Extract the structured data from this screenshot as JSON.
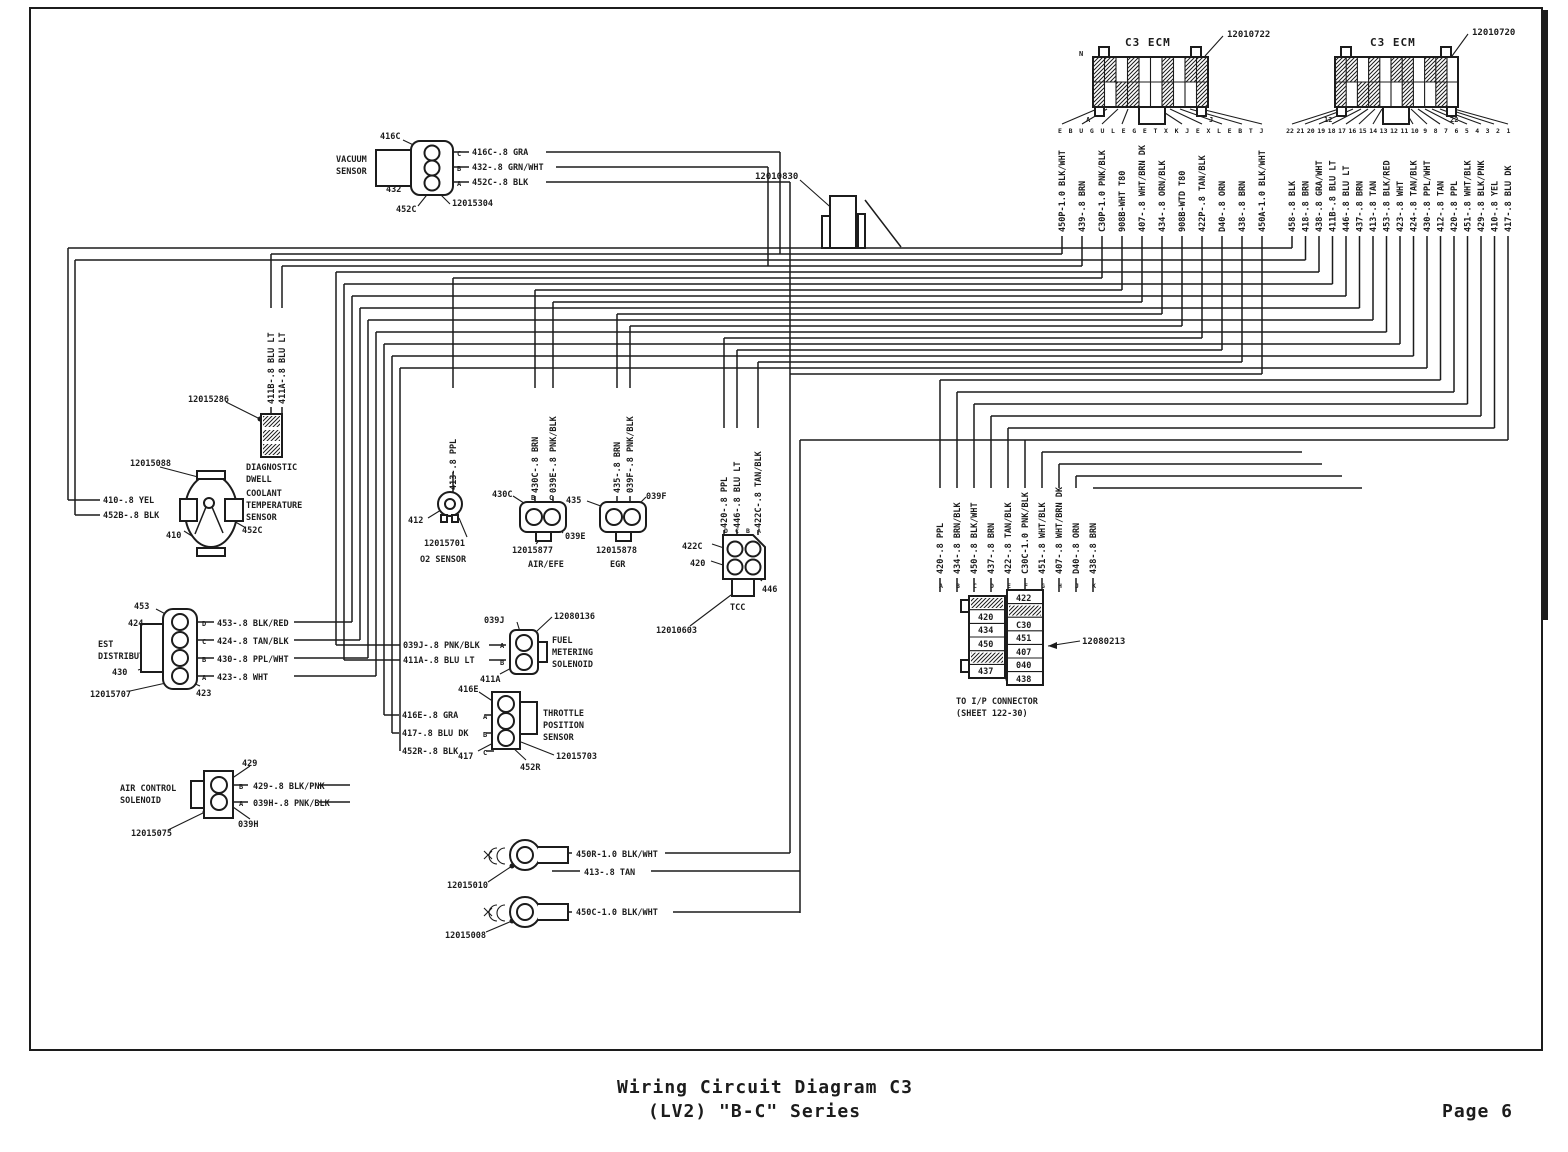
{
  "page": {
    "title_line1": "Wiring Circuit Diagram C3",
    "title_line2": "(LV2) \"B-C\" Series",
    "page_number": "Page 6"
  },
  "colors": {
    "ink": "#1c1c1c",
    "paper": "#ffffff"
  },
  "ecm_left": {
    "title": "C3 ECM",
    "part": "12010722",
    "corner_top": "N",
    "corner_bottom_left": "A",
    "corner_bottom_right": "J",
    "pins": [
      "E",
      "B",
      "U",
      "G",
      "U",
      "L",
      "E",
      "G",
      "E",
      "T",
      "X",
      "K",
      "J",
      "E",
      "X",
      "L",
      "E",
      "B",
      "T",
      "J"
    ],
    "wires": [
      "450P-1.0 BLK/WHT",
      "439-.8 BRN",
      "C30P-1.0 PNK/BLK",
      "908B-WHT T80",
      "407-.8 WHT/BRN DK",
      "434-.8 ORN/BLK",
      "908B-WTD T80",
      "422P-.8 TAN/BLK",
      "D40-.8 ORN",
      "438-.8 BRN",
      "450A-1.0 BLK/WHT"
    ]
  },
  "ecm_right": {
    "title": "C3 ECM",
    "part": "12010720",
    "corner_bottom_left": "12",
    "corner_bottom_right": "22",
    "pins": [
      "22",
      "21",
      "20",
      "19",
      "18",
      "17",
      "16",
      "15",
      "14",
      "13",
      "12",
      "11",
      "10",
      "9",
      "8",
      "7",
      "6",
      "5",
      "4",
      "3",
      "2",
      "1"
    ],
    "wires": [
      "458-.8 BLK",
      "418-.8 BRN",
      "438-.8 GRA/WHT",
      "411B-.8 BLU LT",
      "446-.8 BLU LT",
      "437-.8 BRN",
      "413-.8 TAN",
      "453-.8 BLK/RED",
      "423-.8 WHT",
      "424-.8 TAN/BLK",
      "430-.8 PPL/WHT",
      "412-.8 TAN",
      "420-.8 PPL",
      "451-.8 WHT/BLK",
      "429-.8 BLK/PNK",
      "410-.8 YEL",
      "417-.8 BLU DK"
    ]
  },
  "grommet": {
    "part": "12010830"
  },
  "vacuum_sensor": {
    "name_line1": "VACUUM",
    "name_line2": "SENSOR",
    "part": "12015304",
    "callout_top": "416C",
    "callout_mid": "432",
    "callout_bottom": "452C",
    "pins": [
      "C",
      "B",
      "A"
    ],
    "wires": [
      "416C-.8 GRA",
      "432-.8 GRN/WHT",
      "452C-.8 BLK"
    ]
  },
  "diagnostic": {
    "part": "12015286",
    "name_line1": "DIAGNOSTIC",
    "name_line2": "DWELL",
    "wires": [
      "411B-.8 BLU LT",
      "411A-.8 BLU LT"
    ]
  },
  "coolant": {
    "part": "12015088",
    "name_line1": "COOLANT",
    "name_line2": "TEMPERATURE",
    "name_line3": "SENSOR",
    "wire1": "410-.8 YEL",
    "wire2": "452B-.8 BLK",
    "callout_left": "410",
    "callout_right": "452C"
  },
  "est": {
    "name_line1": "EST",
    "name_line2": "DISTRIBUTOR",
    "part": "12015707",
    "callouts": [
      "453",
      "424",
      "430",
      "423"
    ],
    "pins": [
      "D",
      "C",
      "B",
      "A"
    ],
    "wires": [
      "453-.8 BLK/RED",
      "424-.8 TAN/BLK",
      "430-.8 PPL/WHT",
      "423-.8 WHT"
    ]
  },
  "air_solenoid": {
    "name_line1": "AIR CONTROL",
    "name_line2": "SOLENOID",
    "part": "12015075",
    "callout_top": "429",
    "callout_bottom": "039H",
    "pins": [
      "B",
      "A"
    ],
    "wires": [
      "429-.8 BLK/PNK",
      "039H-.8 PNK/BLK"
    ]
  },
  "o2": {
    "name": "O2 SENSOR",
    "part": "12015701",
    "callout": "412",
    "wire": "413-.8 PPL"
  },
  "air_efe": {
    "name": "AIR/EFE",
    "part": "12015877",
    "callout_left": "430C",
    "callout_right": "039E",
    "pins": [
      "B",
      "C"
    ],
    "wires": [
      "430C-.8 BRN",
      "039E-.8 PNK/BLK"
    ]
  },
  "egr": {
    "name": "EGR",
    "part": "12015878",
    "callout_left": "435",
    "callout_right": "039F",
    "wires": [
      "435-.8 BRN",
      "039F-.8 PNK/BLK"
    ]
  },
  "tcc": {
    "name": "TCC",
    "part": "12010603",
    "callout_a": "422C",
    "callout_b": "420",
    "callout_c": "446",
    "pins": [
      "D",
      "C",
      "B",
      "A"
    ],
    "wires": [
      "420-.8 PPL",
      "446-.8 BLU LT",
      "422C-.8 TAN/BLK"
    ]
  },
  "fms": {
    "name_line1": "FUEL",
    "name_line2": "METERING",
    "name_line3": "SOLENOID",
    "part": "12080136",
    "callout_top": "039J",
    "callout_bottom": "411A",
    "pins": [
      "A",
      "B"
    ],
    "wires": [
      "039J-.8 PNK/BLK",
      "411A-.8 BLU LT"
    ]
  },
  "tps": {
    "name_line1": "THROTTLE",
    "name_line2": "POSITION",
    "name_line3": "SENSOR",
    "part": "12015703",
    "callout_top": "416E",
    "callout_bottom_left": "417",
    "callout_bottom": "452R",
    "pins": [
      "A",
      "B",
      "C"
    ],
    "wires": [
      "416E-.8 GRA",
      "417-.8 BLU DK",
      "452R-.8 BLK"
    ]
  },
  "ring1": {
    "part": "12015010",
    "wire1": "450R-1.0 BLK/WHT",
    "wire2": "413-.8 TAN"
  },
  "ring2": {
    "part": "12015008",
    "wire": "450C-1.0 BLK/WHT"
  },
  "ip": {
    "name_line1": "TO I/P CONNECTOR",
    "name_line2": "(SHEET 122-30)",
    "part": "12080213",
    "pins": [
      "A",
      "B",
      "C",
      "D",
      "E",
      "F",
      "G",
      "H",
      "J",
      "K"
    ],
    "wires": [
      "420-.8 PPL",
      "434-.8 BRN/BLK",
      "450-.8 BLK/WHT",
      "437-.8 BRN",
      "422-.8 TAN/BLK",
      "C30C-1.0 PNK/BLK",
      "451-.8 WHT/BLK",
      "407-.8 WHT/BRN DK",
      "D40-.8 ORN",
      "438-.8 BRN"
    ],
    "cells_left": [
      "420",
      "434",
      "450",
      "437"
    ],
    "cells_right": [
      "422",
      "C30",
      "451",
      "407",
      "040",
      "438"
    ]
  }
}
